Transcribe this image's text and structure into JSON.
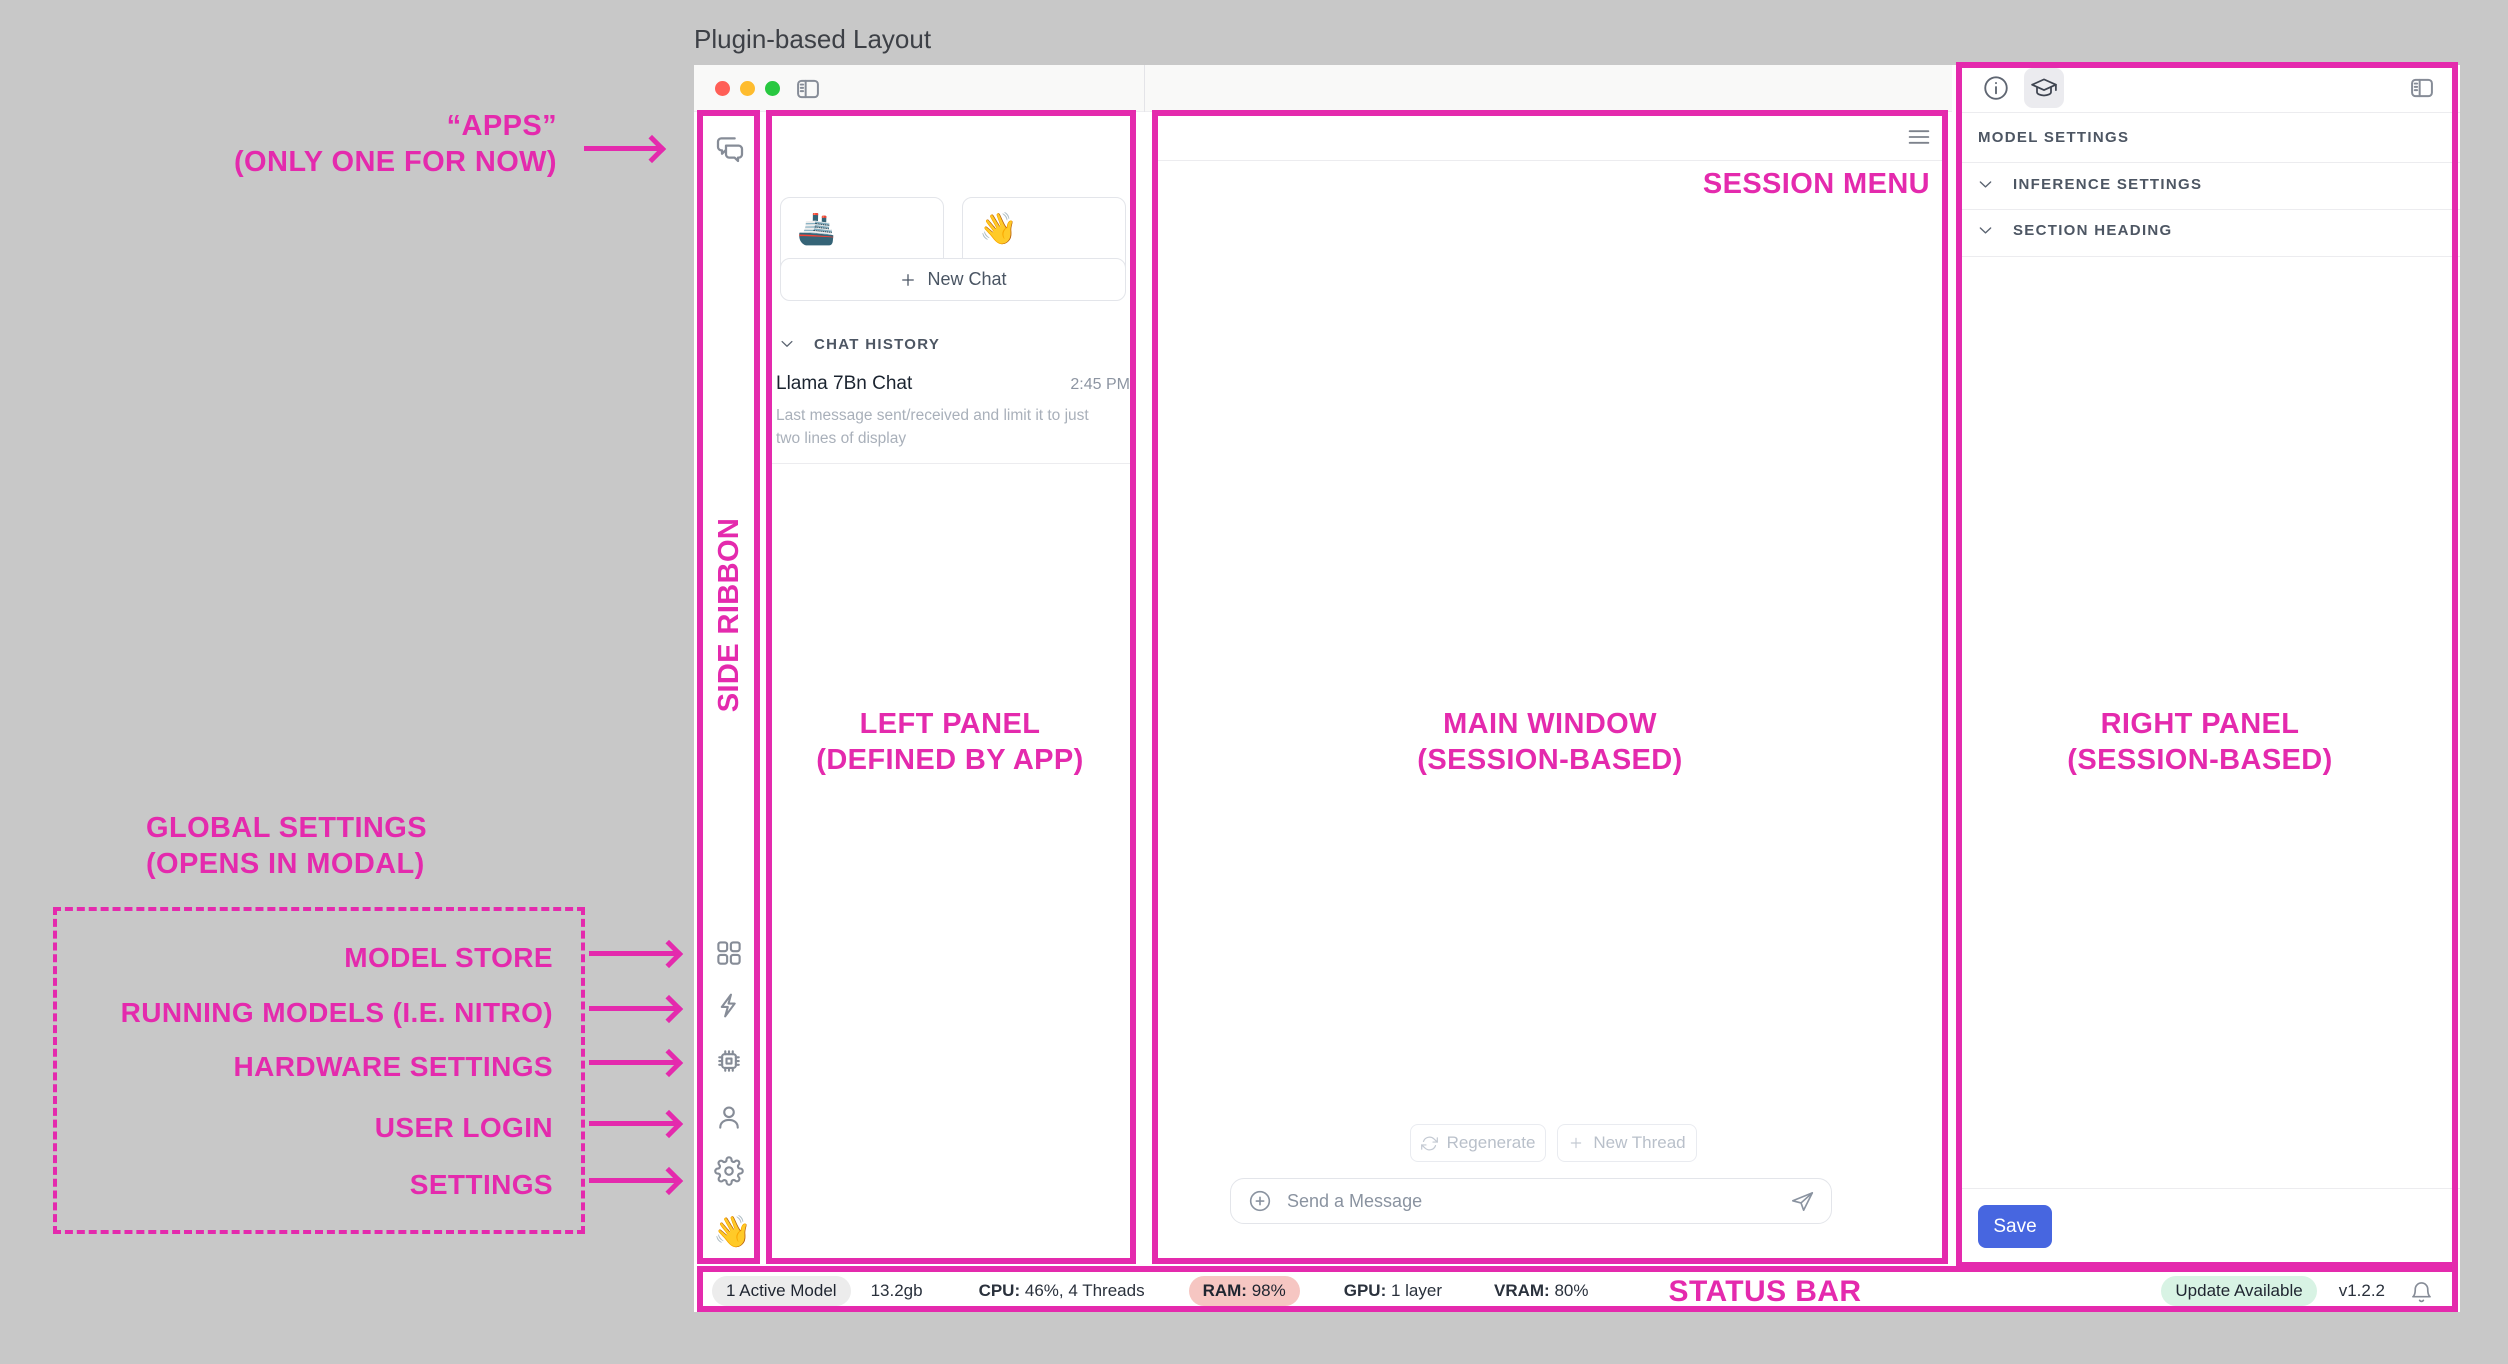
{
  "page_title": "Plugin-based Layout",
  "colors": {
    "magenta": "#e42aad",
    "save_button": "#4766e0",
    "ram_pill_bg": "#f6c6c2",
    "update_pill_bg": "#d8f3e4",
    "active_model_pill_bg": "#ececec",
    "traffic_red": "#ff5f57",
    "traffic_yellow": "#febc2e",
    "traffic_green": "#28c840"
  },
  "annotations": {
    "apps_line1": "“APPS”",
    "apps_line2": "(ONLY ONE FOR NOW)",
    "side_ribbon": "SIDE RIBBON",
    "left_panel_line1": "LEFT PANEL",
    "left_panel_line2": "(DEFINED BY APP)",
    "main_window_line1": "MAIN WINDOW",
    "main_window_line2": "(SESSION-BASED)",
    "right_panel_line1": "RIGHT PANEL",
    "right_panel_line2": "(SESSION-BASED)",
    "session_menu": "SESSION MENU",
    "status_bar": "STATUS BAR",
    "global_settings_line1": "GLOBAL SETTINGS",
    "global_settings_line2": "(OPENS IN MODAL)",
    "global_items": [
      "MODEL STORE",
      "RUNNING MODELS (I.E. NITRO)",
      "HARDWARE SETTINGS",
      "USER LOGIN",
      "SETTINGS"
    ]
  },
  "left_panel": {
    "explore_card": {
      "emoji": "🚢",
      "label": "Explore",
      "affordance": ">"
    },
    "create_bot_card": {
      "emoji": "👋",
      "label": "Create Bot",
      "affordance": "+"
    },
    "new_chat_label": "New Chat",
    "chat_history_header": "CHAT HISTORY",
    "chat_item": {
      "title": "Llama 7Bn Chat",
      "time": "2:45 PM",
      "preview": "Last message sent/received and limit it to just two lines of display"
    }
  },
  "ribbon": {
    "hand_emoji": "👋"
  },
  "main": {
    "regenerate_label": "Regenerate",
    "new_thread_label": "New Thread",
    "message_placeholder": "Send a Message"
  },
  "right_panel": {
    "section_label": "MODEL SETTINGS",
    "sections": [
      "INFERENCE SETTINGS",
      "SECTION HEADING"
    ],
    "save_label": "Save"
  },
  "status_bar": {
    "active_model": "1 Active Model",
    "size": "13.2gb",
    "cpu_label": "CPU:",
    "cpu_value": "46%, 4 Threads",
    "ram_label": "RAM:",
    "ram_value": "98%",
    "gpu_label": "GPU:",
    "gpu_value": "1 layer",
    "vram_label": "VRAM:",
    "vram_value": "80%",
    "update_badge": "Update Available",
    "version": "v1.2.2"
  }
}
